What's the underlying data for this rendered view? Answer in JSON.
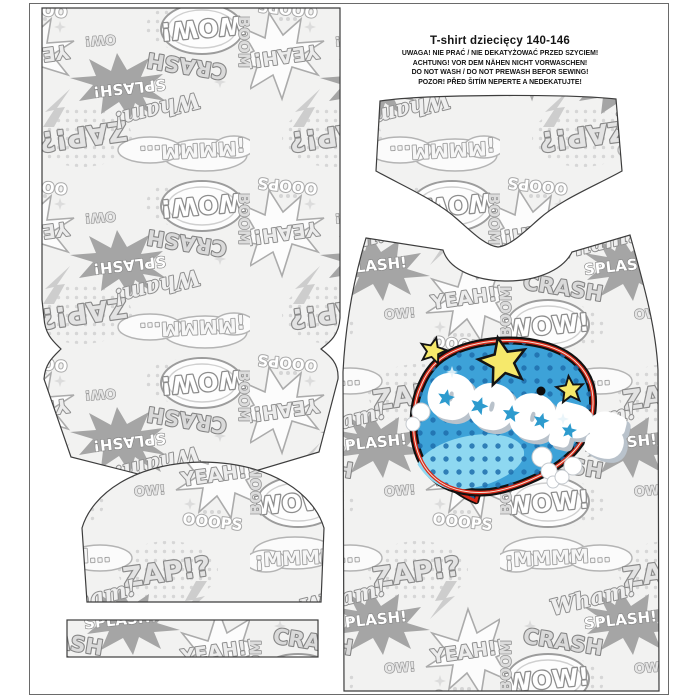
{
  "header": {
    "title": "T-shirt dziecięcy 140-146",
    "warnings": [
      "UWAGA! NIE PRAĆ / NIE DEKATYŻOWAĆ PRZED SZYCIEM!",
      "ACHTUNG! VOR DEM NÄHEN NICHT VORWASCHEN!",
      "DO NOT WASH / DO NOT PREWASH BEFOR SEWING!",
      "POZOR! PŘED ŠITÍM NEPERTE A NEDEKATUJTE!"
    ]
  },
  "fabric": {
    "style": "grayscale comic pop-art collage",
    "words": [
      "WOW!",
      "ZAP!?",
      "YEAH!!",
      "CRASH",
      "SPLASH!",
      "¡MMMM...",
      "OOOPS",
      "BOOM",
      "Wham!",
      "OW!"
    ]
  },
  "motif": {
    "text": "OOOPS",
    "colors": {
      "bubble_blue": "#3DA2D8",
      "dot_blue": "#1E6FAD",
      "light_blue": "#8ED8F1",
      "tail_blue": "#5FBDE4",
      "ring_red": "#D92A1A",
      "star_yellow": "#F6E96B",
      "outline_black": "#111111",
      "cloud_white": "#FFFFFF",
      "cloud_shadow": "#B9C2CB"
    }
  }
}
